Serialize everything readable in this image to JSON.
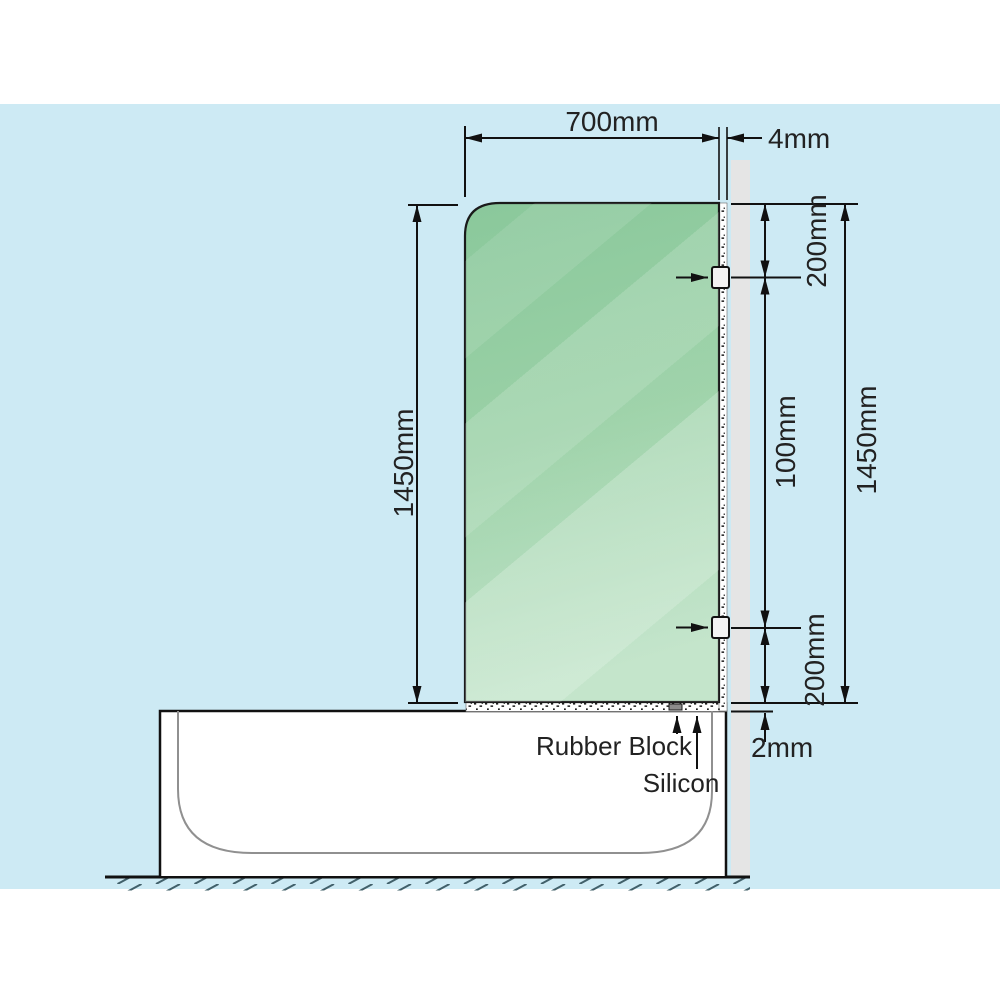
{
  "diagram": {
    "title": "bath shower screen installation diagram",
    "dimensions": {
      "glass_width": "700mm",
      "glass_to_wall_gap": "4mm",
      "glass_height_left": "1450mm",
      "top_bracket_offset": "200mm",
      "between_brackets": "100mm",
      "wall_height_right": "1450mm",
      "bottom_bracket_offset": "200mm",
      "bottom_gap": "2mm"
    },
    "labels": {
      "rubber_block": "Rubber Block",
      "silicon": "Silicon"
    },
    "colors": {
      "background_blue": "#cdeaf4",
      "glass_green_top": "#88c79a",
      "glass_green_bottom": "#c0e3c8",
      "wall_grey": "#e5e5e5",
      "outline_black": "#111111",
      "tub_inner_grey": "#909090",
      "hatch_grey_blue": "#41606a",
      "bracket_fill": "#f2f2f2"
    }
  }
}
